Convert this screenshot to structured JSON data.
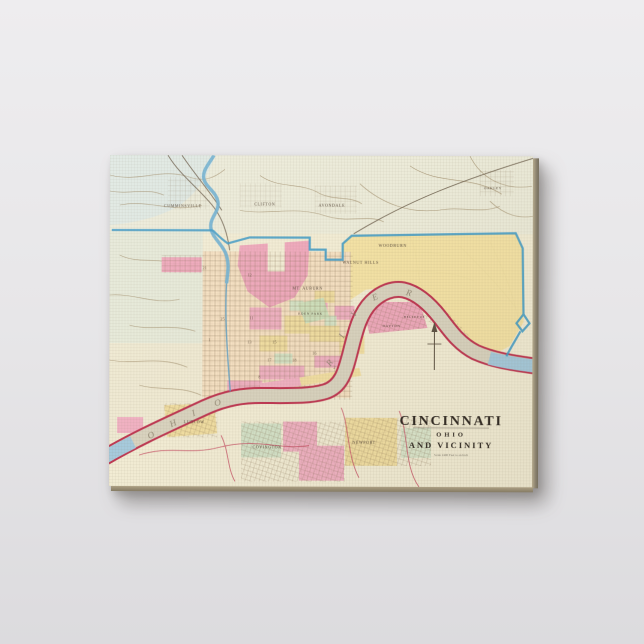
{
  "scene": {
    "description_colors": {
      "background_top": "#eeedef",
      "background_bottom": "#dcdbde"
    }
  },
  "canvas_print": {
    "map_title": "CINCINNATI",
    "map_subtitle": "OHIO",
    "map_subtitle2": "AND VICINITY",
    "map_scale_text": "Scale 2400 Feet to an Inch",
    "colors": {
      "map_cream": "#f2ecd4",
      "district_pink": "#efa9bc",
      "district_yellow": "#f3e2a2",
      "boundary_blue": "#3f9bc8",
      "river_band": "#d9d3bf",
      "river_bank_red": "#bf3752",
      "creek_blue": "#6fb0d2",
      "canvas_edge": "#8d8470"
    },
    "labels": {
      "neighborhoods": [
        {
          "text": "CUMMINSVILLE"
        },
        {
          "text": "CLIFTON"
        },
        {
          "text": "AVONDALE"
        },
        {
          "text": "OAKLEY"
        },
        {
          "text": "WOODBURN"
        },
        {
          "text": "WALNUT HILLS"
        },
        {
          "text": "MT. AUBURN"
        },
        {
          "text": "EDEN PARK"
        },
        {
          "text": "DAYTON"
        },
        {
          "text": "BELLEVUE"
        },
        {
          "text": "LUDLOW"
        },
        {
          "text": "COVINGTON"
        },
        {
          "text": "NEWPORT"
        }
      ],
      "river_letters": [
        "O",
        "H",
        "I",
        "O",
        "R",
        "I",
        "V",
        "E",
        "R"
      ],
      "ward_numbers": [
        "21",
        "12",
        "25",
        "11",
        "13",
        "15",
        "1",
        "17",
        "18",
        "16",
        "2",
        "8"
      ]
    }
  }
}
